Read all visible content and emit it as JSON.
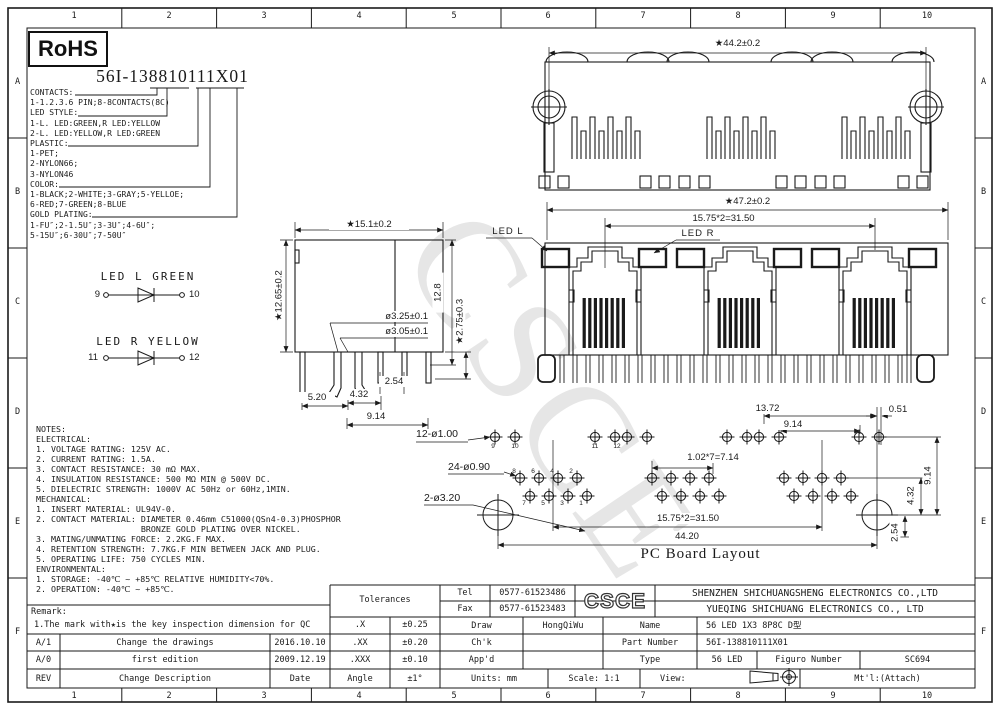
{
  "frame": {
    "cols": [
      "1",
      "2",
      "3",
      "4",
      "5",
      "6",
      "7",
      "8",
      "9",
      "10"
    ],
    "rows": [
      "A",
      "B",
      "C",
      "D",
      "E",
      "F"
    ]
  },
  "watermark": "CSCE",
  "rohs": "RoHS",
  "part_heading": "56I-138810111X01",
  "breakdown": {
    "text": "CONTACTS:\n1-1.2.3.6 PIN;8-8CONTACTS(8C)\nLED STYLE:\n1-L. LED:GREEN,R LED:YELLOW\n2-L. LED:YELLOW,R LED:GREEN\nPLASTIC:\n1-PET;\n2-NYLON66;\n3-NYLON46\nCOLOR:\n1-BLACK;2-WHITE;3-GRAY;5-YELLOE;\n6-RED;7-GREEN;8-BLUE\nGOLD PLATING:\n1-FU″;2-1.5U″;3-3U″;4-6U″;\n5-15U″;6-30U″;7-50U″"
  },
  "led_l": {
    "title": "LED L GREEN",
    "a": "9",
    "b": "10"
  },
  "led_r": {
    "title": "LED R YELLOW",
    "a": "11",
    "b": "12"
  },
  "notes": {
    "text": "NOTES:\nELECTRICAL:\n1. VOLTAGE RATING: 125V AC.\n2. CURRENT RATING: 1.5A.\n3. CONTACT RESISTANCE: 30 mΩ MAX.\n4. INSULATION RESISTANCE: 500 MΩ MIN @ 500V DC.\n5. DIELECTRIC STRENGTH: 1000V AC 50Hz or 60Hz,1MIN.\nMECHANICAL:\n1. INSERT MATERIAL: UL94V-0.\n2. CONTACT MATERIAL: DIAMETER 0.46mm C51000(QSn4-0.3)PHOSPHOR\n                     BRONZE GOLD PLATING OVER NICKEL.\n3. MATING/UNMATING FORCE: 2.2KG.F MAX.\n4. RETENTION STRENGTH: 7.7KG.F MIN BETWEEN JACK AND PLUG.\n5. OPERATING LIFE: 750 CYCLES MIN.\nENVIRONMENTAL:\n1. STORAGE: -40℃ ~ +85℃ RELATIVE HUMIDITY<70%.\n2. OPERATION: -40℃ ~ +85℃."
  },
  "top_view": {
    "dim_width": "★44.2±0.2"
  },
  "front_view": {
    "dim_width": "★47.2±0.2",
    "dim_pitch": "15.75*2=31.50",
    "led_l": "LED L",
    "led_r": "LED R"
  },
  "side_view": {
    "dim_width": "★15.1±0.2",
    "dim_height": "★12.65±0.2",
    "dim_depth": "12.8",
    "dim_tail": "★2.75±0.3",
    "hole_a": "ø3.25±0.1",
    "hole_b": "ø3.05±0.1",
    "d254": "2.54",
    "d520": "5.20",
    "d432": "4.32",
    "d914": "9.14"
  },
  "pcb": {
    "title": "PC Board Layout",
    "led_holes": "12-ø1.00",
    "pin_holes": "24-ø0.90",
    "mount_holes": "2-ø3.20",
    "d1372": "13.72",
    "d914h": "9.14",
    "d051": "0.51",
    "d714": "1.02*7=7.14",
    "d3150": "15.75*2=31.50",
    "d4420": "44.20",
    "d914v": "9.14",
    "d432v": "4.32",
    "d254v": "2.54",
    "led_labels": [
      "9",
      "10",
      "11",
      "12"
    ],
    "top_labels": [
      "8",
      "6",
      "4",
      "2"
    ],
    "bottom_labels": [
      "7",
      "5",
      "3",
      "1"
    ]
  },
  "titleblock": {
    "tolerances_label": "Tolerances",
    "tol": [
      {
        "k": ".X",
        "v": "±0.25"
      },
      {
        "k": ".XX",
        "v": "±0.20"
      },
      {
        "k": ".XXX",
        "v": "±0.10"
      },
      {
        "k": "Angle",
        "v": "±1°"
      }
    ],
    "tel_label": "Tel",
    "tel": "0577-61523486",
    "fax_label": "Fax",
    "fax": "0577-61523483",
    "logo": "CSCE",
    "company1": "SHENZHEN SHICHUANGSHENG ELECTRONICS CO.,LTD",
    "company2": "YUEQING SHICHUANG ELECTRONICS CO., LTD",
    "draw_label": "Draw",
    "draw": "HongQiWu",
    "chk_label": "Ch'k",
    "appd_label": "App'd",
    "name_label": "Name",
    "name": "56 LED 1X3 8P8C D型",
    "part_label": "Part Number",
    "part": "56I-138810111X01",
    "type_label": "Type",
    "type": "56 LED",
    "figure_label": "Figuro Number",
    "figure": "SC694",
    "units_label": "Units: mm",
    "scale_label": "Scale: 1:1",
    "view_label": "View:",
    "mtl_label": "Mt'l:(Attach)",
    "remark_label": "Remark:",
    "remark_line": "1.The mark with★is the key inspection dimension for QC",
    "rev_rows": [
      {
        "rev": "A/1",
        "desc": "Change the drawings",
        "date": "2016.10.10"
      },
      {
        "rev": "A/0",
        "desc": "first edition",
        "date": "2009.12.19"
      },
      {
        "rev": "REV",
        "desc": "Change Description",
        "date": "Date"
      }
    ]
  }
}
